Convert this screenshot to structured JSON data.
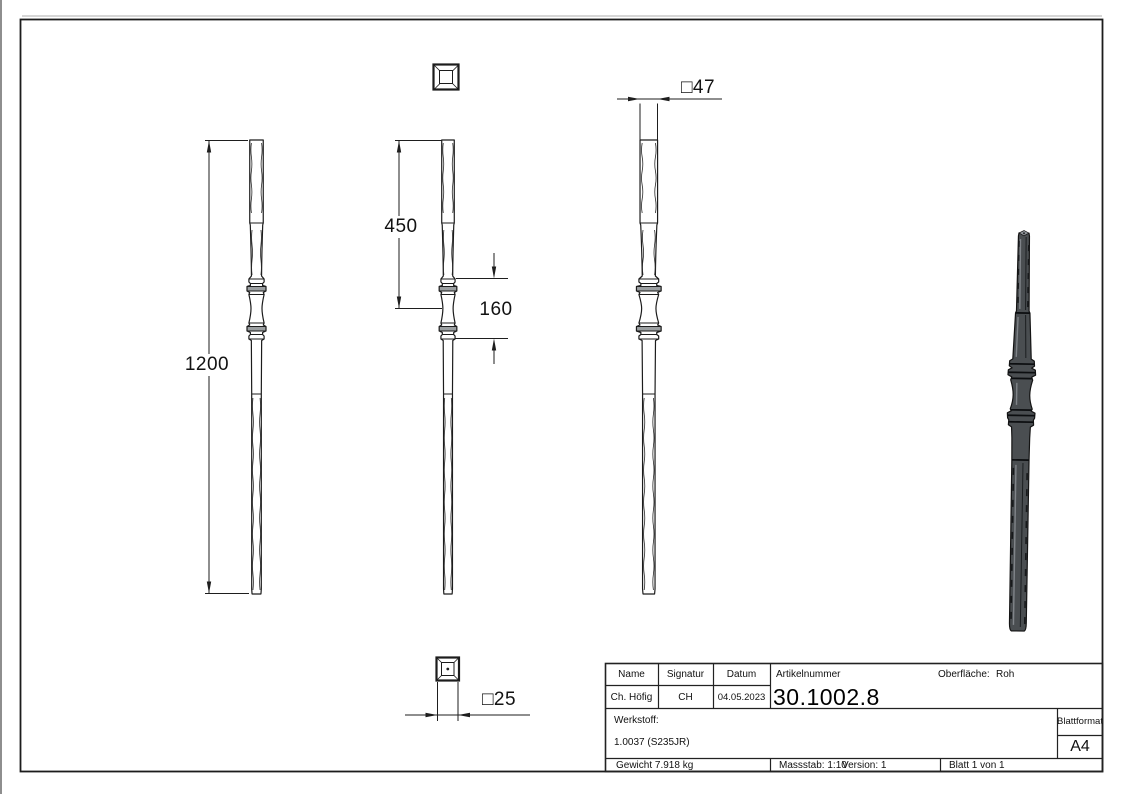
{
  "dimensions": {
    "overall_length": "1200",
    "upper_section": "450",
    "middle_section": "160",
    "square_top": "□47",
    "square_bottom": "□25"
  },
  "title_block": {
    "name_label": "Name",
    "signatur_label": "Signatur",
    "datum_label": "Datum",
    "name_value": "Ch. Höfig",
    "signatur_value": "CH",
    "datum_value": "04.05.2023",
    "artikelnummer_label": "Artikelnummer",
    "artikelnummer_value": "30.1002.8",
    "oberflaeche_label": "Oberfläche:",
    "oberflaeche_value": "Roh",
    "werkstoff_label": "Werkstoff:",
    "werkstoff_value": "1.0037 (S235JR)",
    "blattformat_label": "Blattformat",
    "blattformat_value": "A4",
    "gewicht": "Gewicht 7.918 kg",
    "massstab": "Massstab: 1:10",
    "version": "Version: 1",
    "blatt": "Blatt 1 von 1"
  },
  "colors": {
    "line": "#1c1c1c",
    "model_fill": "#4a4e51",
    "model_highlight": "#868b8f",
    "ring_shade": "#9b9fa1"
  }
}
